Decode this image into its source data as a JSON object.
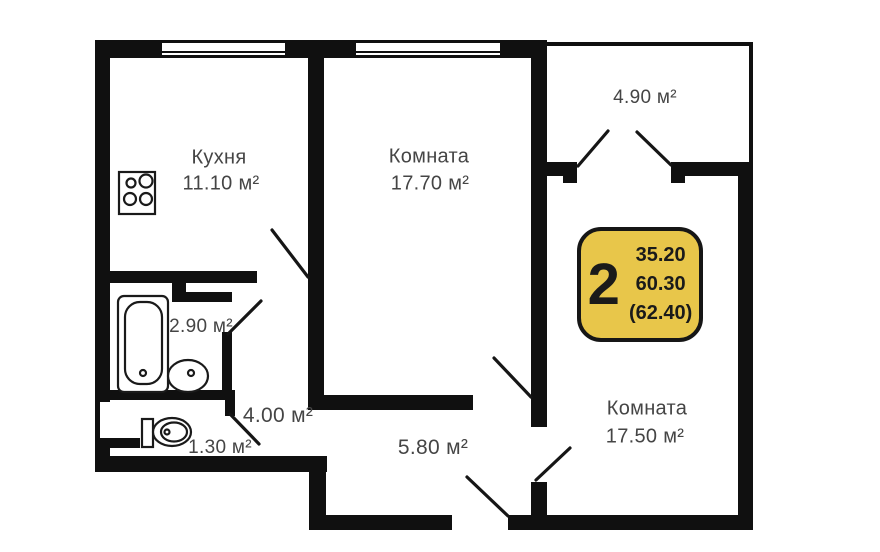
{
  "colors": {
    "bg": "#ffffff",
    "wall": "#101010",
    "label": "#454545",
    "badge_bg": "#e8c64a",
    "badge_border": "#161616",
    "badge_text": "#1a1a1a"
  },
  "rooms": {
    "kitchen": {
      "name": "Кухня",
      "area": "11.10 м²"
    },
    "room1": {
      "name": "Комната",
      "area": "17.70 м²"
    },
    "balcony": {
      "area": "4.90 м²"
    },
    "room2": {
      "name": "Комната",
      "area": "17.50 м²"
    },
    "bathroom": {
      "area": "2.90 м²"
    },
    "hallway": {
      "area": "4.00 м²"
    },
    "wc": {
      "area": "1.30 м²"
    },
    "corridor": {
      "area": "5.80 м²"
    }
  },
  "badge": {
    "room_count": "2",
    "living_area": "35.20",
    "floor_area": "60.30",
    "total_area": "(62.40)"
  }
}
